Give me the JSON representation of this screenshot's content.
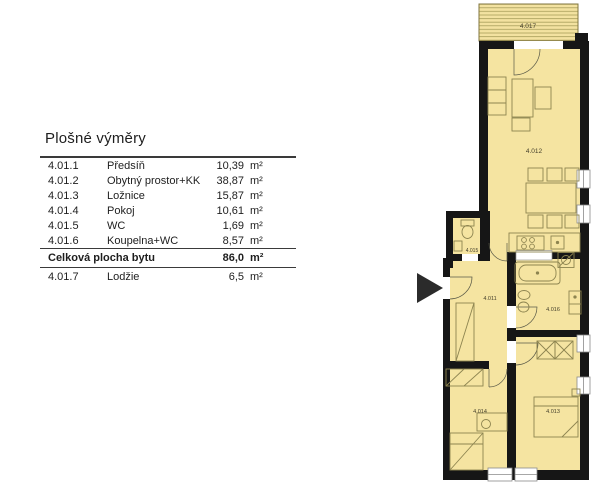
{
  "table": {
    "title": "Plošné výměry",
    "rows": [
      {
        "code": "4.01.1",
        "name": "Předsíň",
        "value": "10,39",
        "unit": "m²"
      },
      {
        "code": "4.01.2",
        "name": "Obytný prostor+KK",
        "value": "38,87",
        "unit": "m²"
      },
      {
        "code": "4.01.3",
        "name": "Ložnice",
        "value": "15,87",
        "unit": "m²"
      },
      {
        "code": "4.01.4",
        "name": "Pokoj",
        "value": "10,61",
        "unit": "m²"
      },
      {
        "code": "4.01.5",
        "name": "WC",
        "value": "1,69",
        "unit": "m²"
      },
      {
        "code": "4.01.6",
        "name": "Koupelna+WC",
        "value": "8,57",
        "unit": "m²"
      }
    ],
    "total": {
      "label": "Celková plocha bytu",
      "value": "86,0",
      "unit": "m²"
    },
    "extra_row": {
      "code": "4.01.7",
      "name": "Lodžie",
      "value": "6,5",
      "unit": "m²"
    }
  },
  "plan": {
    "labels": {
      "loggia": "4.017",
      "living": "4.012",
      "wc": "4.015",
      "hall": "4.011",
      "bath": "4.016",
      "room4": "4.014",
      "bedroom": "4.013"
    },
    "colors": {
      "room_fill": "#f5e4a1",
      "wall": "#161616",
      "furniture_stroke": "#8d8450"
    }
  }
}
